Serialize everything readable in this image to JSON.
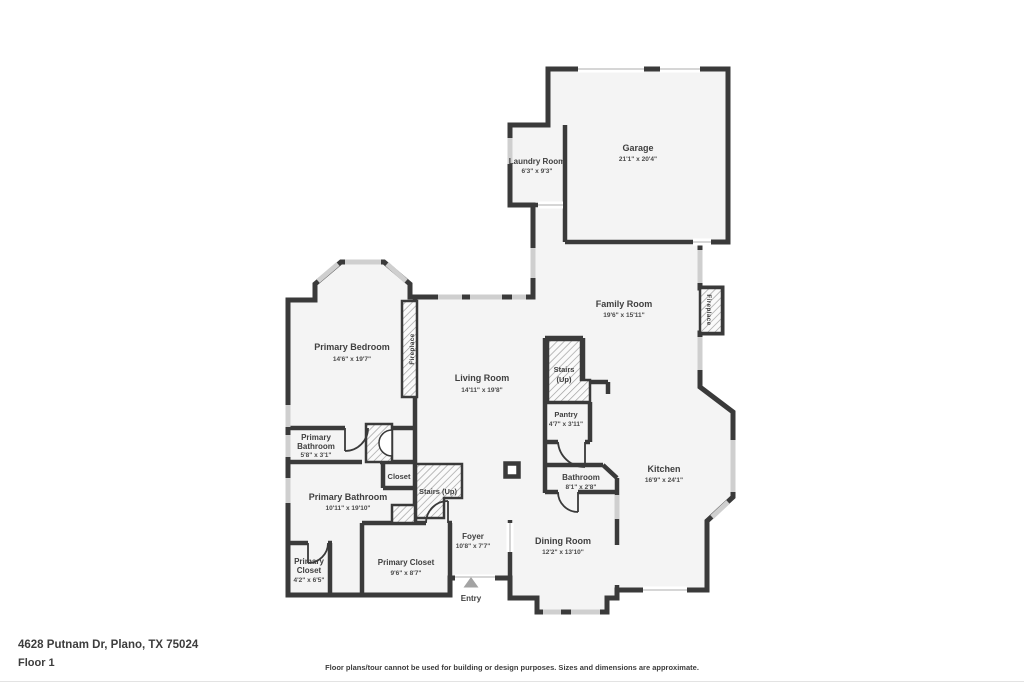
{
  "meta": {
    "address": "4628 Putnam Dr, Plano, TX 75024",
    "floor_label": "Floor 1",
    "disclaimer": "Floor plans/tour cannot be used for building or design purposes. Sizes and dimensions are approximate."
  },
  "colors": {
    "wall": "#3a3a3a",
    "room_fill": "#f4f4f4",
    "window": "#cfcfcf",
    "threshold": "#c9c9c9",
    "hatch_line": "#9a9a9a",
    "label_text": "#3f3f3f",
    "dims_text": "#4a4a4a",
    "entry_arrow": "#a3a3a3",
    "footer_text": "#3d3d3d",
    "page_bg": "#ffffff",
    "border": "#e3e3e3"
  },
  "rooms": {
    "garage": {
      "name": "Garage",
      "dims": "21'1\" x 20'4\""
    },
    "laundry_room": {
      "name": "Laundry Room",
      "dims": "6'3\" x 9'3\""
    },
    "family_room": {
      "name": "Family Room",
      "dims": "19'6\" x 15'11\""
    },
    "primary_bedroom": {
      "name": "Primary Bedroom",
      "dims": "14'6\" x 19'7\""
    },
    "living_room": {
      "name": "Living Room",
      "dims": "14'11\" x 19'8\""
    },
    "stairs_upper": {
      "line1": "Stairs",
      "line2": "(Up)"
    },
    "pantry": {
      "name": "Pantry",
      "dims": "4'7\" x 3'11\""
    },
    "primary_bathroom_small": {
      "line1": "Primary",
      "line2": "Bathroom",
      "dims": "5'8\" x 3'1\""
    },
    "primary_bathroom": {
      "name": "Primary Bathroom",
      "dims": "10'11\" x 19'10\""
    },
    "closet": {
      "name": "Closet"
    },
    "stairs_main": {
      "label": "Stairs (Up)"
    },
    "primary_closet_small": {
      "line1": "Primary",
      "line2": "Closet",
      "dims": "4'2\" x 6'5\""
    },
    "primary_closet": {
      "name": "Primary Closet",
      "dims": "9'6\" x 8'7\""
    },
    "foyer": {
      "name": "Foyer",
      "dims": "10'8\" x 7'7\""
    },
    "bathroom": {
      "name": "Bathroom",
      "dims": "8'1\" x 2'8\""
    },
    "dining_room": {
      "name": "Dining Room",
      "dims": "12'2\" x 13'10\""
    },
    "kitchen": {
      "name": "Kitchen",
      "dims": "16'9\" x 24'1\""
    },
    "fireplace_bedroom": {
      "name": "Fireplace"
    },
    "fireplace_family": {
      "name": "Fireplace"
    },
    "entry": {
      "name": "Entry"
    }
  }
}
